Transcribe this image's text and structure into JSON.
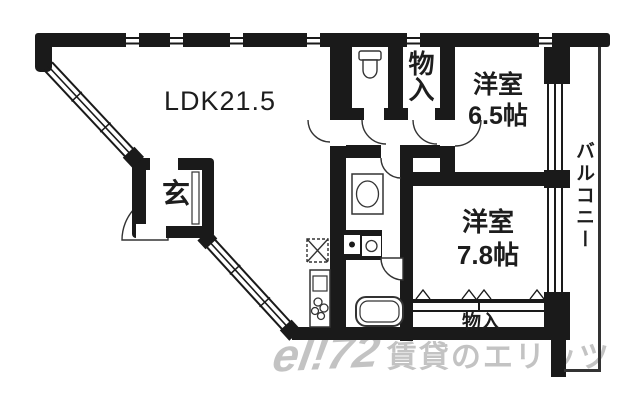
{
  "floorplan": {
    "background": "#ffffff",
    "wall_color": "#1a1a1a",
    "line_color": "#333333",
    "labels": {
      "ldk": "LDK21.5",
      "room1_name": "洋室",
      "room1_size": "6.5帖",
      "room2_name": "洋室",
      "room2_size": "7.8帖",
      "balcony": "バルコニー",
      "entrance": "玄",
      "storage_upper": "物入",
      "closet_lower": "物入"
    },
    "icons": {
      "toilet": "toilet-icon",
      "washbasin": "washbasin-icon",
      "bathtub": "bathtub-icon",
      "stove_burners": "stove-burners-icon",
      "kitchen_counter": "kitchen-counter-icon",
      "vent_hatch": "vent-hatch-icon",
      "washing_machine": "washing-machine-icon",
      "door_swing": "door-swing-arc-icon",
      "sliding_door": "sliding-door-marks-icon",
      "window": "window-triple-line-icon"
    }
  },
  "watermark": {
    "logo": "el!72",
    "text": "賃貸のエリッツ",
    "color": "#c3c3c3"
  }
}
